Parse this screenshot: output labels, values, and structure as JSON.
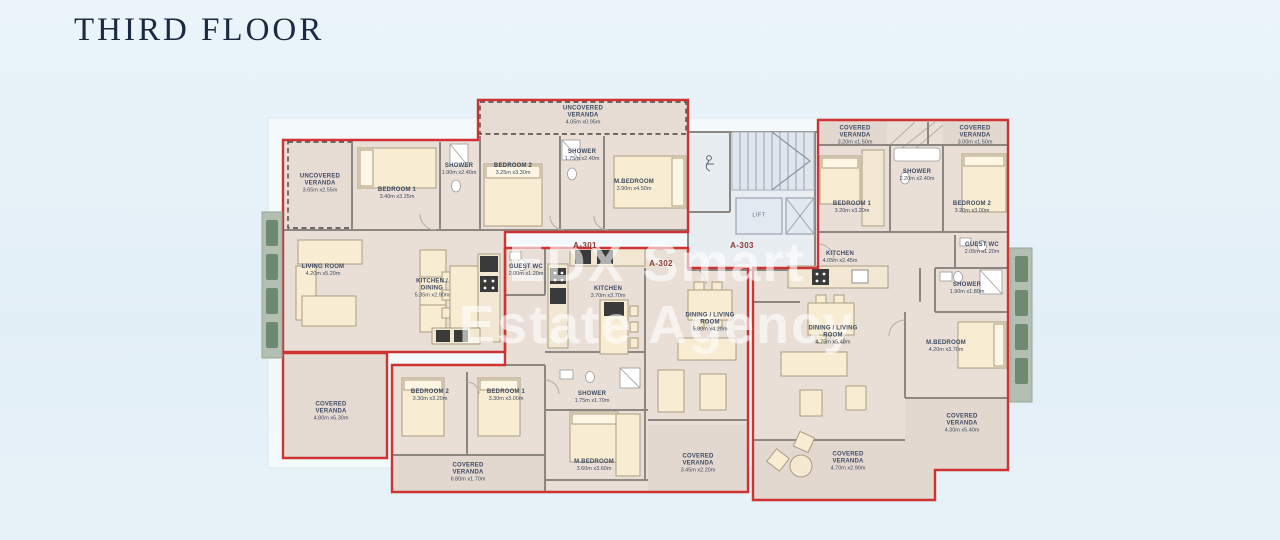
{
  "title": "THIRD FLOOR",
  "watermark": {
    "line1": "EDX Smart",
    "line2": "Estate Agency"
  },
  "colors": {
    "background": "#e7f1f8",
    "boundary_red": "#ce3332",
    "room_fill": "#e9dfd7",
    "veranda_fill": "#e3d8d0",
    "wall_gray": "#8d8781",
    "furniture_cream": "#f8ecd2",
    "louver_green": "#7b927c",
    "title_navy": "#1b2a40",
    "label_blue": "#3f4c63",
    "apartment_code_red": "#8c3a33"
  },
  "apartments": [
    {
      "code": "A-301"
    },
    {
      "code": "A-302"
    },
    {
      "code": "A-303"
    }
  ],
  "labels": [
    {
      "t": "UNCOVERED VERANDA",
      "d": "3.65m x2.55m",
      "x": 320,
      "y": 184,
      "kind": "room"
    },
    {
      "t": "BEDROOM 1",
      "d": "3.40m x3.25m",
      "x": 397,
      "y": 194,
      "kind": "room"
    },
    {
      "t": "SHOWER",
      "d": "1.90m x2.40m",
      "x": 459,
      "y": 170,
      "kind": "room"
    },
    {
      "t": "UNCOVERED VERANDA",
      "d": "4.05m x0.95m",
      "x": 583,
      "y": 116,
      "kind": "room"
    },
    {
      "t": "BEDROOM 2",
      "d": "3.25m x3.30m",
      "x": 513,
      "y": 170,
      "kind": "room"
    },
    {
      "t": "SHOWER",
      "d": "1.75m x2.40m",
      "x": 582,
      "y": 156,
      "kind": "room"
    },
    {
      "t": "M.BEDROOM",
      "d": "3.90m x4.50m",
      "x": 634,
      "y": 186,
      "kind": "room"
    },
    {
      "t": "LIVING ROOM",
      "d": "4.20m x5.20m",
      "x": 323,
      "y": 271,
      "kind": "room"
    },
    {
      "t": "KITCHEN / DINING",
      "d": "5.35m x2.90m",
      "x": 432,
      "y": 289,
      "kind": "room"
    },
    {
      "t": "COVERED VERANDA",
      "d": "4.80m x5.30m",
      "x": 331,
      "y": 412,
      "kind": "room"
    },
    {
      "t": "GUEST WC",
      "d": "2.00m x1.20m",
      "x": 526,
      "y": 271,
      "kind": "room"
    },
    {
      "t": "KITCHEN",
      "d": "3.70m x3.70m",
      "x": 608,
      "y": 293,
      "kind": "room"
    },
    {
      "t": "DINING / LIVING ROOM",
      "d": "5.80m x4.20m",
      "x": 710,
      "y": 323,
      "kind": "room"
    },
    {
      "t": "BEDROOM 2",
      "d": "3.30m x3.20m",
      "x": 430,
      "y": 396,
      "kind": "room"
    },
    {
      "t": "BEDROOM 1",
      "d": "3.30m x3.00m",
      "x": 506,
      "y": 396,
      "kind": "room"
    },
    {
      "t": "SHOWER",
      "d": "1.75m x1.70m",
      "x": 592,
      "y": 398,
      "kind": "room"
    },
    {
      "t": "M.BEDROOM",
      "d": "3.60m x3.60m",
      "x": 594,
      "y": 466,
      "kind": "room"
    },
    {
      "t": "COVERED VERANDA",
      "d": "6.80m x1.70m",
      "x": 468,
      "y": 473,
      "kind": "room"
    },
    {
      "t": "COVERED VERANDA",
      "d": "3.45m x2.20m",
      "x": 698,
      "y": 464,
      "kind": "room"
    },
    {
      "t": "COVERED VERANDA",
      "d": "3.20m x1.50m",
      "x": 855,
      "y": 136,
      "kind": "room"
    },
    {
      "t": "COVERED VERANDA",
      "d": "3.00m x1.50m",
      "x": 975,
      "y": 136,
      "kind": "room"
    },
    {
      "t": "BEDROOM 1",
      "d": "3.20m x3.20m",
      "x": 852,
      "y": 208,
      "kind": "room"
    },
    {
      "t": "SHOWER",
      "d": "2.20m x2.40m",
      "x": 917,
      "y": 176,
      "kind": "room"
    },
    {
      "t": "BEDROOM 2",
      "d": "3.20m x3.00m",
      "x": 972,
      "y": 208,
      "kind": "room"
    },
    {
      "t": "KITCHEN",
      "d": "4.05m x2.45m",
      "x": 840,
      "y": 258,
      "kind": "room"
    },
    {
      "t": "GUEST WC",
      "d": "2.05m x1.20m",
      "x": 982,
      "y": 249,
      "kind": "room"
    },
    {
      "t": "SHOWER",
      "d": "1.90m x1.80m",
      "x": 967,
      "y": 289,
      "kind": "room"
    },
    {
      "t": "M.BEDROOM",
      "d": "4.20m x3.70m",
      "x": 946,
      "y": 347,
      "kind": "room"
    },
    {
      "t": "DINING / LIVING ROOM",
      "d": "4.75m x5.40m",
      "x": 833,
      "y": 336,
      "kind": "room"
    },
    {
      "t": "COVERED VERANDA",
      "d": "4.30m x5.40m",
      "x": 962,
      "y": 424,
      "kind": "room"
    },
    {
      "t": "COVERED VERANDA",
      "d": "4.70m x2.90m",
      "x": 848,
      "y": 462,
      "kind": "room"
    },
    {
      "t": "A-301",
      "x": 585,
      "y": 246,
      "kind": "code"
    },
    {
      "t": "A-302",
      "x": 661,
      "y": 264,
      "kind": "code"
    },
    {
      "t": "A-303",
      "x": 742,
      "y": 246,
      "kind": "code"
    },
    {
      "t": "LIFT",
      "x": 759,
      "y": 216,
      "kind": "lift"
    }
  ]
}
